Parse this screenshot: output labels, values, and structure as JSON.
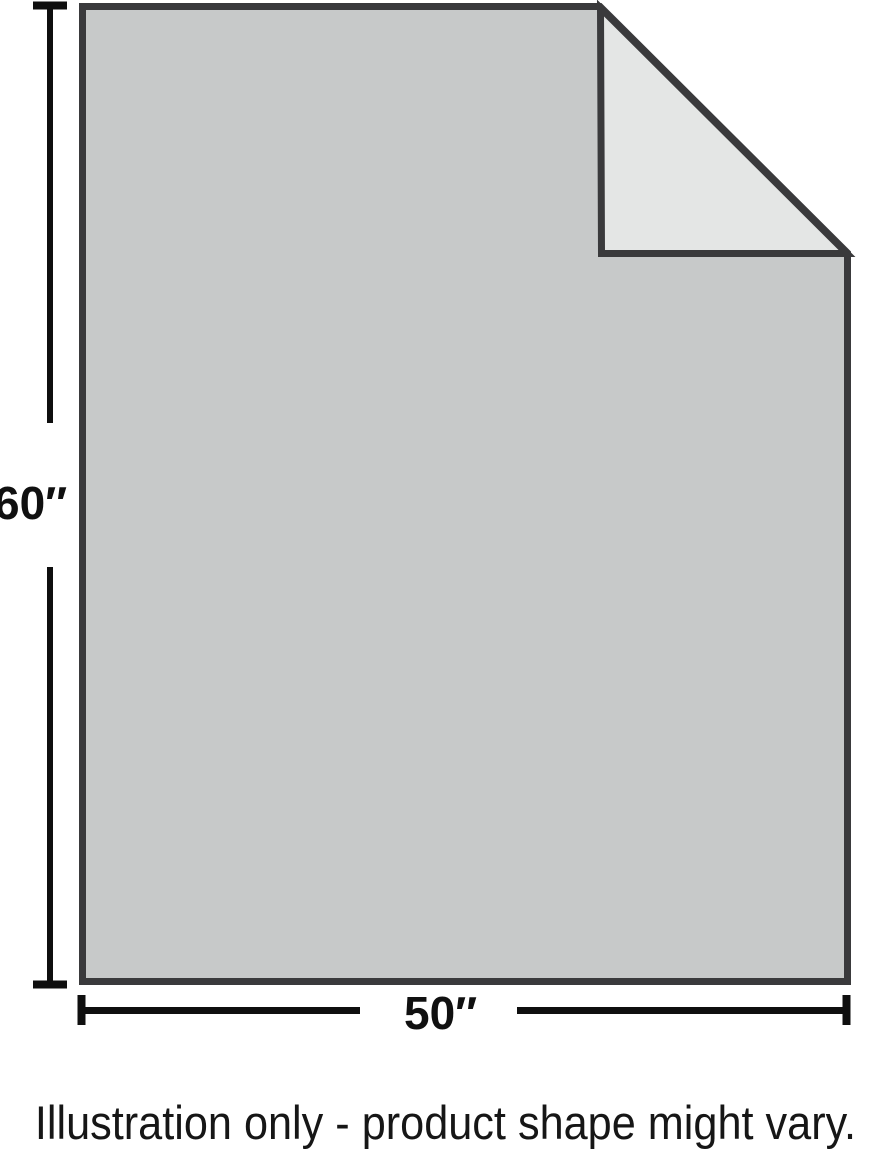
{
  "illustration": {
    "height_label": "60″",
    "width_label": "50″",
    "caption": "Illustration only - product shape might vary."
  },
  "colors": {
    "product_fill": "#c7c9c9",
    "fold_fill": "#e4e6e5",
    "outline": "#3a3a3c",
    "dimension_line": "#0f0f0f",
    "text": "#161616",
    "background": "#ffffff"
  }
}
